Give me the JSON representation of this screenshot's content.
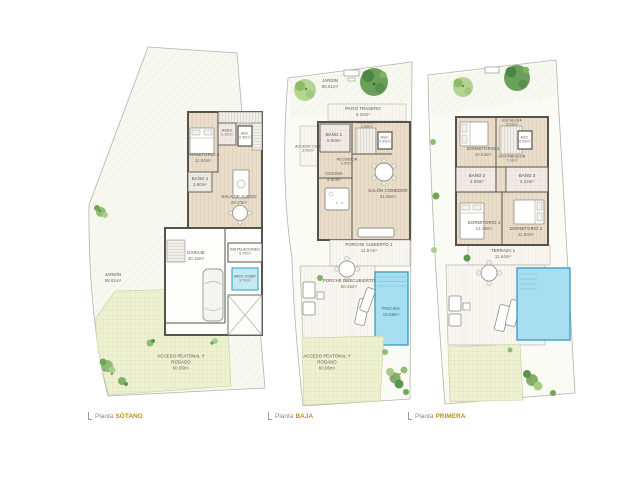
{
  "colors": {
    "caption_accent": "#c1901c",
    "caption_text": "#8a8a85",
    "pool_fill": "#a8dff0",
    "pool_border": "#419fc4",
    "wood_floor": "#e9ddca",
    "grass_fill": "#eef2d3",
    "wall": "#55534e",
    "label_text": "#55514a"
  },
  "plans": {
    "sotano": {
      "caption": {
        "prefix": "Planta",
        "name": "SÓTANO"
      },
      "rooms": {
        "dormitorio4": {
          "label": "DORMITORIO 4",
          "area": "11.50m²"
        },
        "aseo": {
          "label": "ASEO",
          "area": "2.10m²"
        },
        "asc": {
          "label": "ASC.",
          "area": "0.55m²"
        },
        "bano4": {
          "label": "BAÑO 4",
          "area": "3.90m²"
        },
        "sala_de_juego": {
          "label": "SALA DE JUEGO",
          "area": "29.10m²"
        },
        "garaje": {
          "label": "GARAJE",
          "area": "40.15m²"
        },
        "instalaciones": {
          "label": "INSTALACIONES",
          "area": "5.75m²"
        },
        "vaso_comp": {
          "label": "VASO COMP.",
          "area": "3.70m²"
        },
        "jardin": {
          "label": "JARDÍN",
          "area": "98.61m²"
        },
        "acceso": {
          "label": "ACCESO PEATONAL Y",
          "label2": "RODADO",
          "area": "60.95m²"
        }
      }
    },
    "baja": {
      "caption": {
        "prefix": "Planta",
        "name": "BAJA"
      },
      "rooms": {
        "jardin": {
          "label": "JARDÍN",
          "area": "58.61m²"
        },
        "patio_trasero": {
          "label": "PATIO TRASERO",
          "area": "6.25m²"
        },
        "bano1": {
          "label": "BAÑO 1",
          "area": "5.50m²"
        },
        "escalera": {
          "label": "ESCALERA",
          "area": "5.96m²"
        },
        "asc": {
          "label": "ASC.",
          "area": "0.55m²"
        },
        "recibidor": {
          "label": "RECIBIDOR",
          "area": "9.55m²"
        },
        "acceso_cub": {
          "label": "ACCESO CUB.",
          "area": "3.00m²"
        },
        "cocina": {
          "label": "COCINA",
          "area": "9.90m²"
        },
        "salon_comedor": {
          "label": "SALÓN COMEDOR",
          "area": "31.86m²"
        },
        "porche_cubierto": {
          "label": "PORCHE CUBIERTO 1",
          "area": "11.67m²"
        },
        "porche_descubierto": {
          "label": "PORCHE DESCUBIERTO",
          "area": "50.45m²"
        },
        "piscina": {
          "label": "PISCINA",
          "area": "10.69m²"
        },
        "acceso": {
          "label": "ACCESO PEATONAL Y",
          "label2": "RODADO",
          "area": "60.95m²"
        }
      }
    },
    "primera": {
      "caption": {
        "prefix": "Planta",
        "name": "PRIMERA"
      },
      "rooms": {
        "dormitorio3": {
          "label": "DORMITORIO 3",
          "area": "10.54m²"
        },
        "escalera": {
          "label": "ESCALERA",
          "area": "5.69m²"
        },
        "asc": {
          "label": "ASC.",
          "area": "0.55m²"
        },
        "distribuidor": {
          "label": "DISTRIBUIDOR",
          "area": "7.16m²"
        },
        "bano2": {
          "label": "BAÑO 2",
          "area": "4.09m²"
        },
        "bano3": {
          "label": "BAÑO 3",
          "area": "4.23m²"
        },
        "dormitorio1": {
          "label": "DORMITORIO 1",
          "area": "14.45m²"
        },
        "dormitorio2": {
          "label": "DORMITORIO 2",
          "area": "11.50m²"
        },
        "terraza1": {
          "label": "TERRAZA 1",
          "area": "11.64m²"
        }
      }
    }
  }
}
